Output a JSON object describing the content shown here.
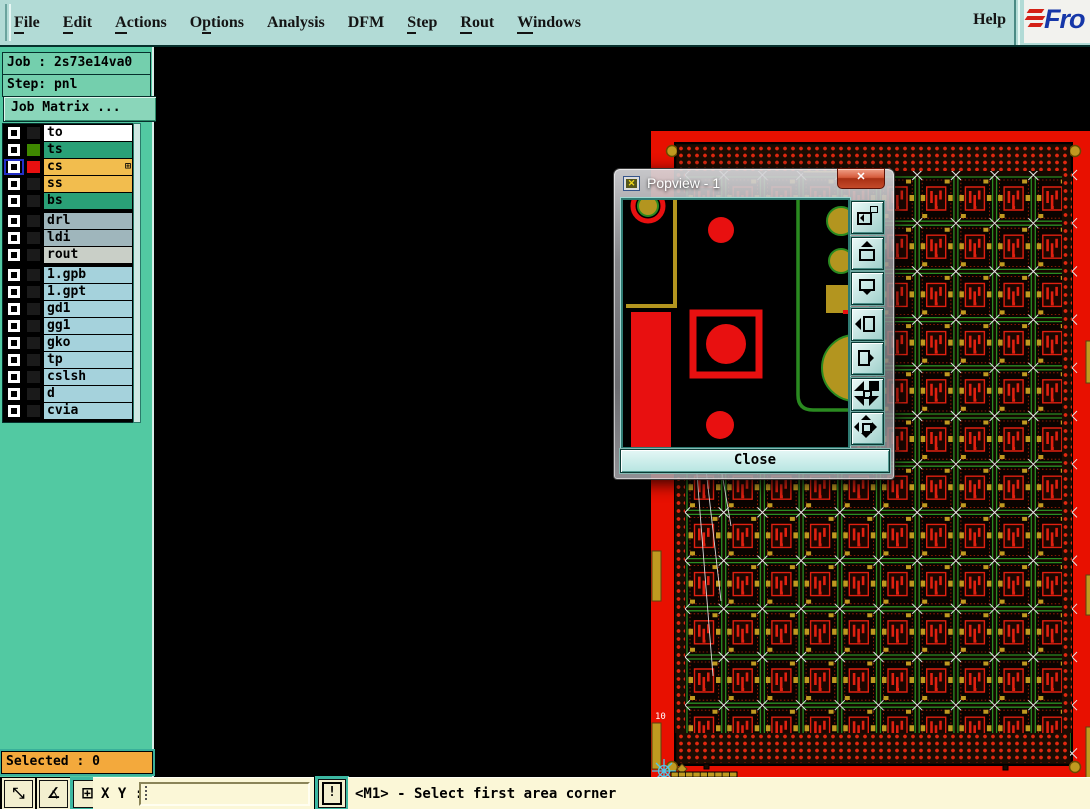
{
  "menubar": {
    "items": [
      {
        "label": "File",
        "underline": 0
      },
      {
        "label": "Edit",
        "underline": 0
      },
      {
        "label": "Actions",
        "underline": 0
      },
      {
        "label": "Options",
        "underline": 1
      },
      {
        "label": "Analysis",
        "underline": -1
      },
      {
        "label": "DFM",
        "underline": -1
      },
      {
        "label": "Step",
        "underline": 0
      },
      {
        "label": "Rout",
        "underline": 0
      },
      {
        "label": "Windows",
        "underline": 0
      }
    ],
    "help_label": "Help",
    "logo_text": "Fro"
  },
  "sidebar": {
    "job_label": "Job : 2s73e14va0",
    "step_label": "Step: pnl",
    "job_matrix_label": "Job Matrix ...",
    "selected_label": "Selected : 0",
    "layer_groups": [
      {
        "rows": [
          {
            "label": "to",
            "row_bg": "#ffffff",
            "swatch": "#1a1a1a",
            "active": false,
            "badge": ""
          },
          {
            "label": "ts",
            "row_bg": "#2aa077",
            "swatch": "#3f8800",
            "active": false,
            "badge": ""
          },
          {
            "label": "cs",
            "row_bg": "#f2bd4e",
            "swatch": "#e81010",
            "active": true,
            "badge": "⊞"
          },
          {
            "label": "ss",
            "row_bg": "#f2bd4e",
            "swatch": "#1a1a1a",
            "active": false,
            "badge": ""
          },
          {
            "label": "bs",
            "row_bg": "#2aa077",
            "swatch": "#1a1a1a",
            "active": false,
            "badge": ""
          }
        ]
      },
      {
        "rows": [
          {
            "label": "drl",
            "row_bg": "#9fb6bc",
            "swatch": "#1a1a1a",
            "active": false,
            "badge": ""
          },
          {
            "label": "ldi",
            "row_bg": "#9fb6bc",
            "swatch": "#1a1a1a",
            "active": false,
            "badge": ""
          },
          {
            "label": "rout",
            "row_bg": "#c9cfc7",
            "swatch": "#1a1a1a",
            "active": false,
            "badge": ""
          }
        ]
      },
      {
        "rows": [
          {
            "label": "1.gpb",
            "row_bg": "#a5d2dc",
            "swatch": "#1a1a1a",
            "active": false,
            "badge": ""
          },
          {
            "label": "1.gpt",
            "row_bg": "#a5d2dc",
            "swatch": "#1a1a1a",
            "active": false,
            "badge": ""
          },
          {
            "label": "gd1",
            "row_bg": "#a5d2dc",
            "swatch": "#1a1a1a",
            "active": false,
            "badge": ""
          },
          {
            "label": "gg1",
            "row_bg": "#a5d2dc",
            "swatch": "#1a1a1a",
            "active": false,
            "badge": ""
          },
          {
            "label": "gko",
            "row_bg": "#a5d2dc",
            "swatch": "#1a1a1a",
            "active": false,
            "badge": ""
          },
          {
            "label": "tp",
            "row_bg": "#a5d2dc",
            "swatch": "#1a1a1a",
            "active": false,
            "badge": ""
          },
          {
            "label": "cslsh",
            "row_bg": "#a5d2dc",
            "swatch": "#1a1a1a",
            "active": false,
            "badge": ""
          },
          {
            "label": "d",
            "row_bg": "#a5d2dc",
            "swatch": "#1a1a1a",
            "active": false,
            "badge": ""
          },
          {
            "label": "cvia",
            "row_bg": "#a5d2dc",
            "swatch": "#1a1a1a",
            "active": false,
            "badge": ""
          }
        ]
      }
    ]
  },
  "popup": {
    "title": "Popview - 1",
    "close_x": "✕",
    "close_label": "Close",
    "toolbar": [
      {
        "name": "open-in-window-icon"
      },
      {
        "name": "pan-up-icon"
      },
      {
        "name": "pan-down-icon"
      },
      {
        "name": "pan-left-icon"
      },
      {
        "name": "pan-right-icon"
      },
      {
        "name": "shrink-view-icon"
      },
      {
        "name": "expand-view-icon"
      }
    ],
    "colors": {
      "red": "#e81010",
      "olive": "#b3951f",
      "green": "#2a8a20"
    }
  },
  "statusbar": {
    "xy_label": "X Y :",
    "input_value": "",
    "message": "<M1> - Select first area corner",
    "buttons": [
      {
        "name": "measure-distance",
        "glyph": "⤡"
      },
      {
        "name": "measure-angle",
        "glyph": "∡"
      },
      {
        "name": "grid-window",
        "glyph": "⊞"
      },
      {
        "name": "prompt-alert",
        "glyph": "!"
      }
    ]
  },
  "pcb_panel": {
    "frame_color": "#e81000",
    "board_color": "#150800",
    "dot_color": "#e02810",
    "cell_color": "#2a8c22",
    "pad_color": "#e02010",
    "gold_color": "#c09a20",
    "mark_color": "#e6e6e6",
    "crosshair_color": "#50c8e8",
    "grid_cols": 10,
    "grid_rows": 12,
    "edge_label": "10"
  }
}
